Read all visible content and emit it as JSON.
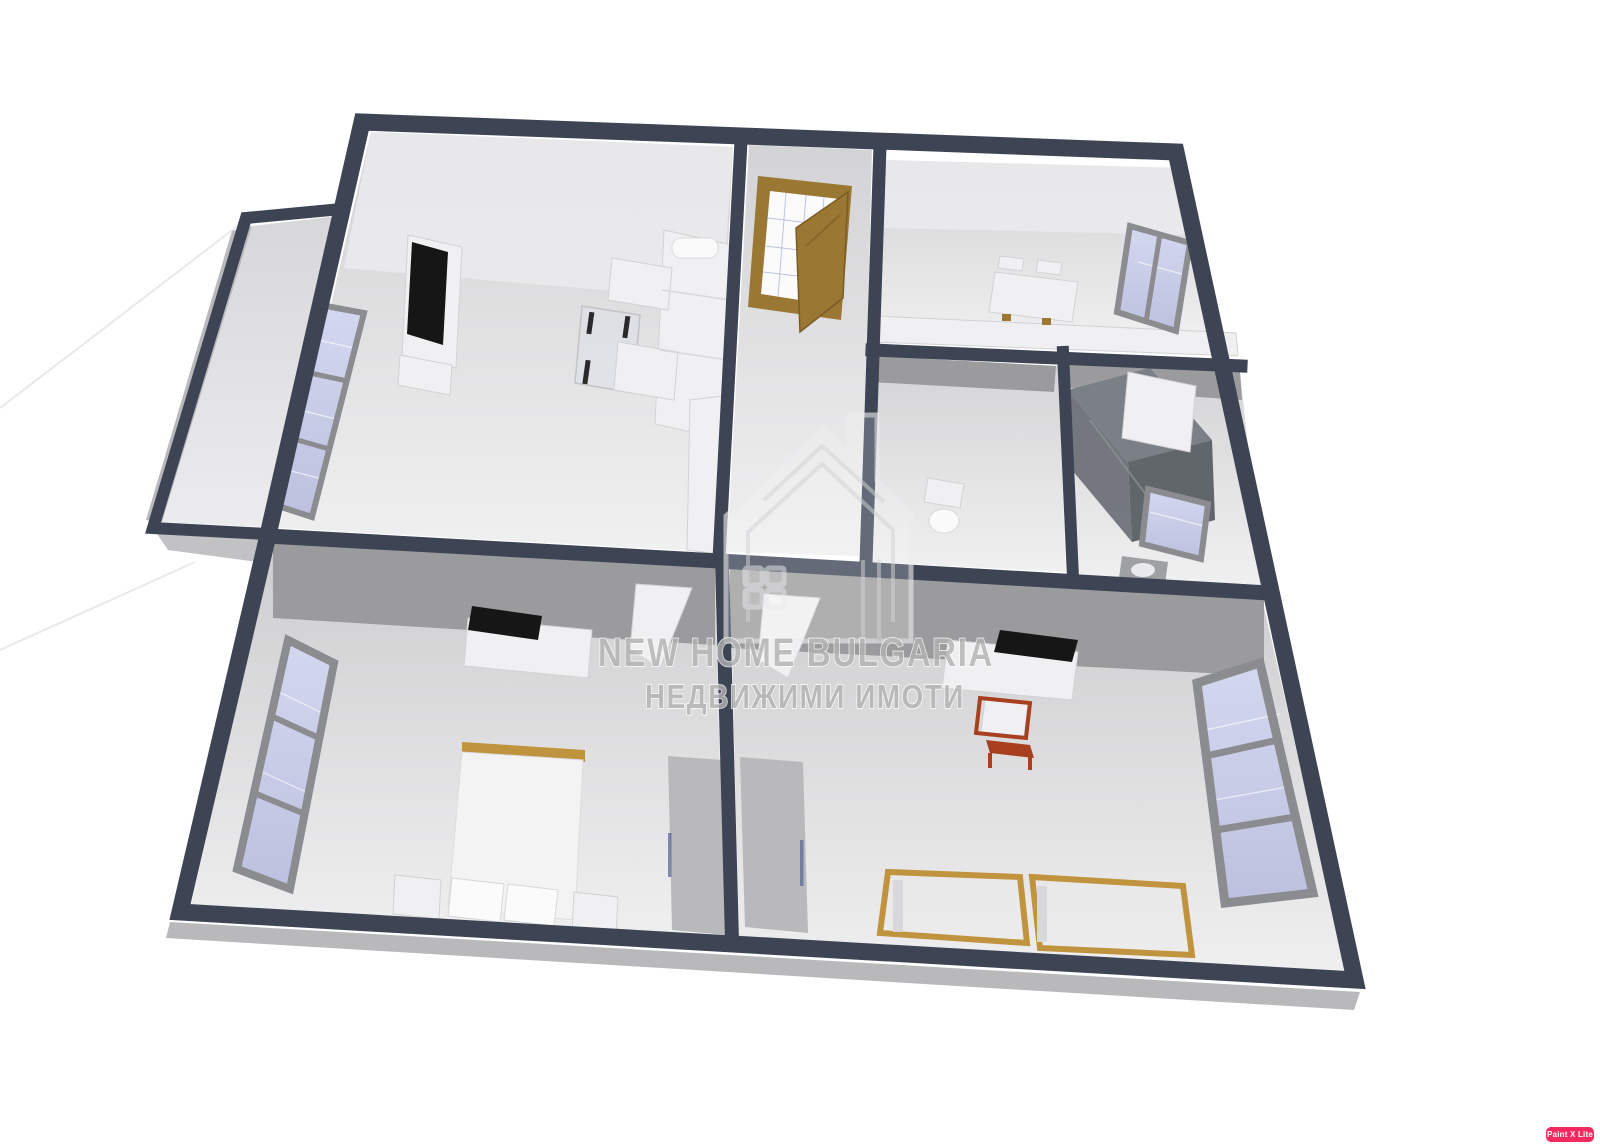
{
  "canvas": {
    "width": 1600,
    "height": 1148,
    "background": "#ffffff"
  },
  "watermark": {
    "logo": "house-outline-icon",
    "line1": "NEW HOME BULGARIA",
    "line2": "НЕДВИЖИМИ ИМОТИ"
  },
  "app_badge": {
    "label": "Paint X Lite"
  },
  "palette": {
    "wall-dark": "#3d4454",
    "wall-face": "#9b9b9d",
    "frame-gray": "#8a8c8f",
    "glass": "#c7cbe6",
    "door-wood": "#9a7733",
    "bed-wood": "#c0933f",
    "desk-red": "#a8401f",
    "furn-white": "#f0f0f2",
    "furn-gray": "#b9b9bb",
    "shower-dark": "#5d6268",
    "tv-black": "#161616",
    "badge-bg": "#f42a5e",
    "badge-fg": "#ffffff",
    "watermark-fill": "#b2b2b2",
    "watermark-stroke": "#ffffff"
  },
  "floor_plan": {
    "view": "3d-perspective-top-down",
    "rooms": [
      {
        "id": "balcony",
        "furniture": []
      },
      {
        "id": "living-room",
        "furniture": [
          "wall-tv",
          "tv-cabinet",
          "corner-sofa",
          "glass-coffee-table",
          "triple-window",
          "open-door"
        ]
      },
      {
        "id": "entry-hall",
        "furniture": [
          "wood-glass-entrance-door"
        ]
      },
      {
        "id": "kitchen",
        "furniture": [
          "dining-table",
          "chairs",
          "counter",
          "window"
        ]
      },
      {
        "id": "wc",
        "furniture": [
          "toilet"
        ]
      },
      {
        "id": "bathroom",
        "furniture": [
          "shower-cabin",
          "washer-box",
          "small-window",
          "sink"
        ]
      },
      {
        "id": "bedroom-left",
        "furniture": [
          "double-bed",
          "pillows",
          "nightstands",
          "tv",
          "dresser",
          "wardrobe",
          "triple-window",
          "open-door"
        ]
      },
      {
        "id": "bedroom-right",
        "furniture": [
          "bed-frame",
          "bed-frame",
          "desk",
          "chair",
          "tv",
          "dresser",
          "wardrobe",
          "triple-window",
          "open-door"
        ]
      }
    ]
  }
}
